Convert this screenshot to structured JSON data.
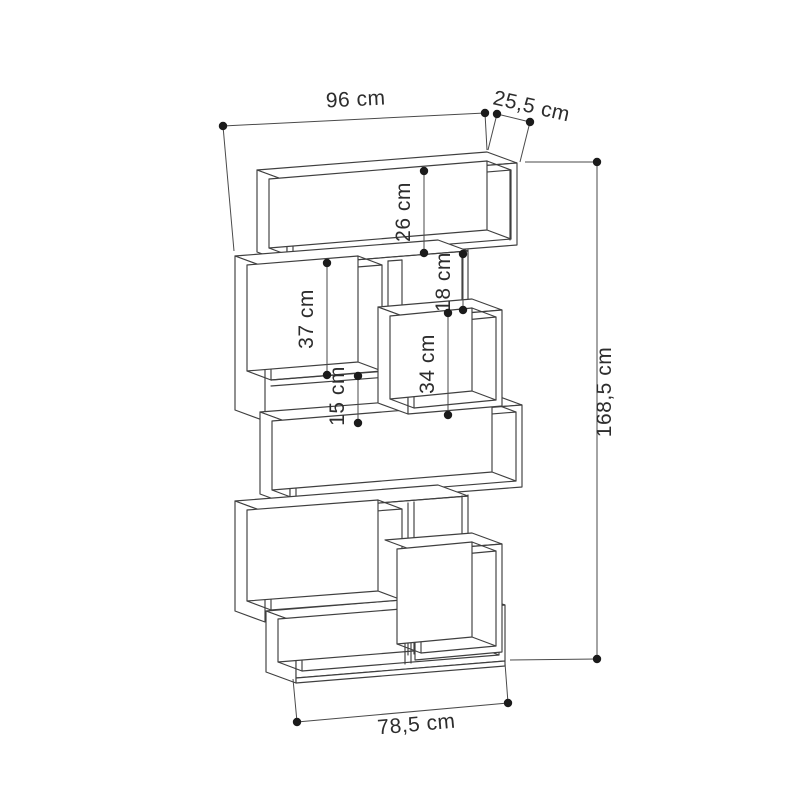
{
  "diagram": {
    "kind": "furniture-dimension-drawing",
    "subject": "zigzag staggered bookcase, oblique line drawing",
    "background_color": "#ffffff",
    "line_color": "#3f3f3f",
    "text_color": "#2d2d2d",
    "units": "cm",
    "dims": {
      "width_top": {
        "name": "overall width",
        "value": 96,
        "label": "96 cm"
      },
      "depth": {
        "name": "depth",
        "value": 25.5,
        "label": "25,5 cm"
      },
      "height_overall": {
        "name": "overall height",
        "value": 168.5,
        "label": "168,5 cm"
      },
      "width_bottom": {
        "name": "base width",
        "value": 78.5,
        "label": "78,5 cm"
      },
      "top_compartment": {
        "name": "top compartment height",
        "value": 26,
        "label": "26 cm"
      },
      "left_compartment": {
        "name": "upper left compartment height",
        "value": 37,
        "label": "37 cm"
      },
      "right_gap": {
        "name": "upper right gap height",
        "value": 18,
        "label": "18 cm"
      },
      "right_compartment": {
        "name": "right compartment height",
        "value": 34,
        "label": "34 cm"
      },
      "left_gap": {
        "name": "middle left gap height",
        "value": 15,
        "label": "15 cm"
      }
    }
  }
}
